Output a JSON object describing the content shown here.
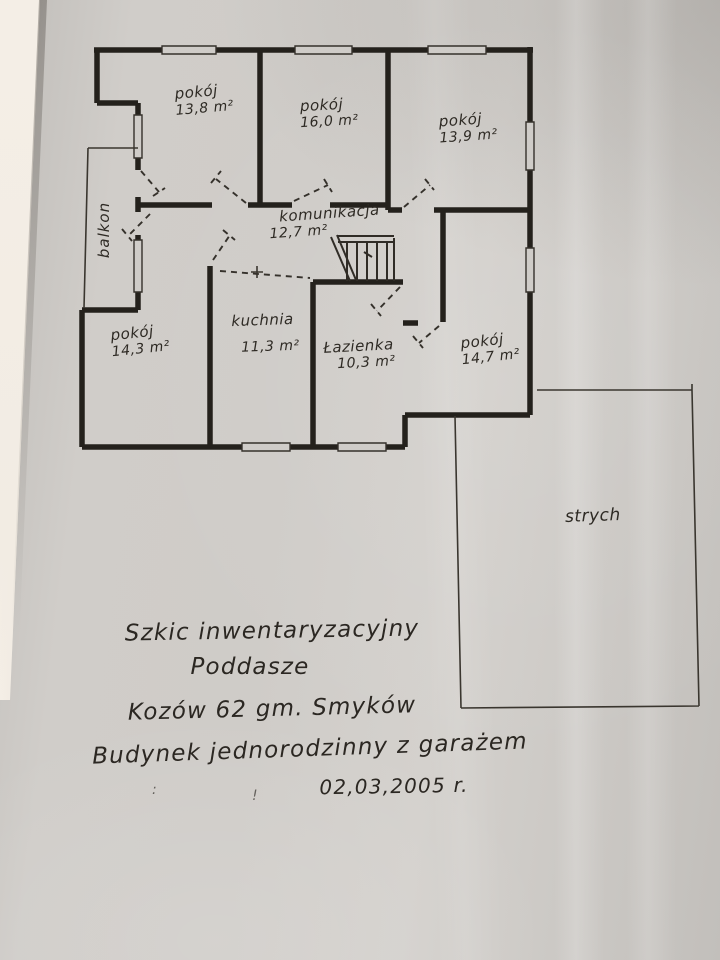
{
  "plan": {
    "rooms": [
      {
        "name": "pokój",
        "area": "13,8 m²"
      },
      {
        "name": "pokój",
        "area": "16,0 m²"
      },
      {
        "name": "pokój",
        "area": "13,9 m²"
      },
      {
        "name": "komunikacja",
        "area": "12,7 m²"
      },
      {
        "name": "pokój",
        "area": "14,3 m²"
      },
      {
        "name": "kuchnia",
        "area": "11,3 m²"
      },
      {
        "name": "Łazienka",
        "area": "10,3 m²"
      },
      {
        "name": "pokój",
        "area": "14,7 m²"
      }
    ],
    "balcony_label": "balkon",
    "attic_label": "strych"
  },
  "caption": {
    "title": "Szkic inwentaryzacyjny",
    "subtitle": "Poddasze",
    "address": "Kozów 62  gm. Smyków",
    "building": "Budynek jednorodzinny z garażem",
    "date": "02,03,2005 r."
  },
  "stray_marks": {
    "m1": ":",
    "m2": "!"
  },
  "colors": {
    "ink": "#2b2722",
    "paper": "#cfccc8",
    "table": "#f4eee6"
  }
}
